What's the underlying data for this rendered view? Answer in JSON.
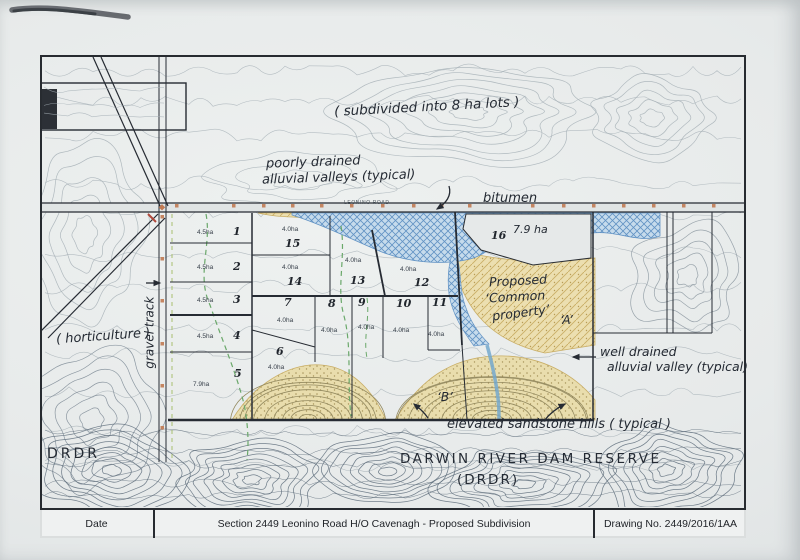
{
  "title_block": {
    "date_label": "Date",
    "title": "Section 2449 Leonino Road H/O Cavenagh - Proposed Subdivision",
    "drawing_no": "Drawing No. 2449/2016/1AA"
  },
  "map": {
    "road_label": "LEONINO ROAD",
    "annotations": {
      "subdivided": "( subdivided into 8 ha lots )",
      "poorly_drained_1": "poorly drained",
      "poorly_drained_2": "alluvial valleys (typical)",
      "bitumen": "bitumen",
      "proposed_1": "Proposed",
      "proposed_2": "‘Common",
      "proposed_3": "property’",
      "label_a": "‘A’",
      "well_drained_1": "well drained",
      "well_drained_2": "alluvial valley (typical)",
      "label_b": "‘B’",
      "elevated": "elevated sandstone hills ( typical )",
      "dam_reserve_1": "DARWIN RIVER DAM RESERVE",
      "dam_reserve_2": "(DRDR)",
      "drdr": "DRDR",
      "horticulture": "( horticulture )",
      "gravel_track": "gravel track"
    },
    "lots": [
      {
        "num": "1",
        "area": "4.5ha"
      },
      {
        "num": "2",
        "area": "4.5ha"
      },
      {
        "num": "3",
        "area": "4.5ha"
      },
      {
        "num": "4",
        "area": "4.5ha"
      },
      {
        "num": "5",
        "area": "7.9ha"
      },
      {
        "num": "6",
        "area": "4.0ha"
      },
      {
        "num": "7",
        "area": "4.0ha"
      },
      {
        "num": "8",
        "area": "4.0ha"
      },
      {
        "num": "9",
        "area": "4.0ha"
      },
      {
        "num": "10",
        "area": "4.0ha"
      },
      {
        "num": "11",
        "area": "4.0ha"
      },
      {
        "num": "12",
        "area": "4.0ha"
      },
      {
        "num": "13",
        "area": "4.0ha"
      },
      {
        "num": "14",
        "area": "4.0ha"
      },
      {
        "num": "15",
        "area": "4.0ha"
      },
      {
        "num": "16",
        "area": "7.9 ha"
      }
    ]
  },
  "colors": {
    "ink": "#262b33",
    "poorly_drained_fill": "#c6dbec",
    "poorly_drained_line": "#6293c4",
    "alluvial_fill": "#ecdfb0",
    "alluvial_line": "#c9ae66",
    "creek_green": "#6aa86a",
    "survey_mark_orange": "#c17a52",
    "contour_light": "#a6b0b6",
    "contour_dark": "#5f6e7c",
    "contour_sandstone": "#93895f"
  }
}
